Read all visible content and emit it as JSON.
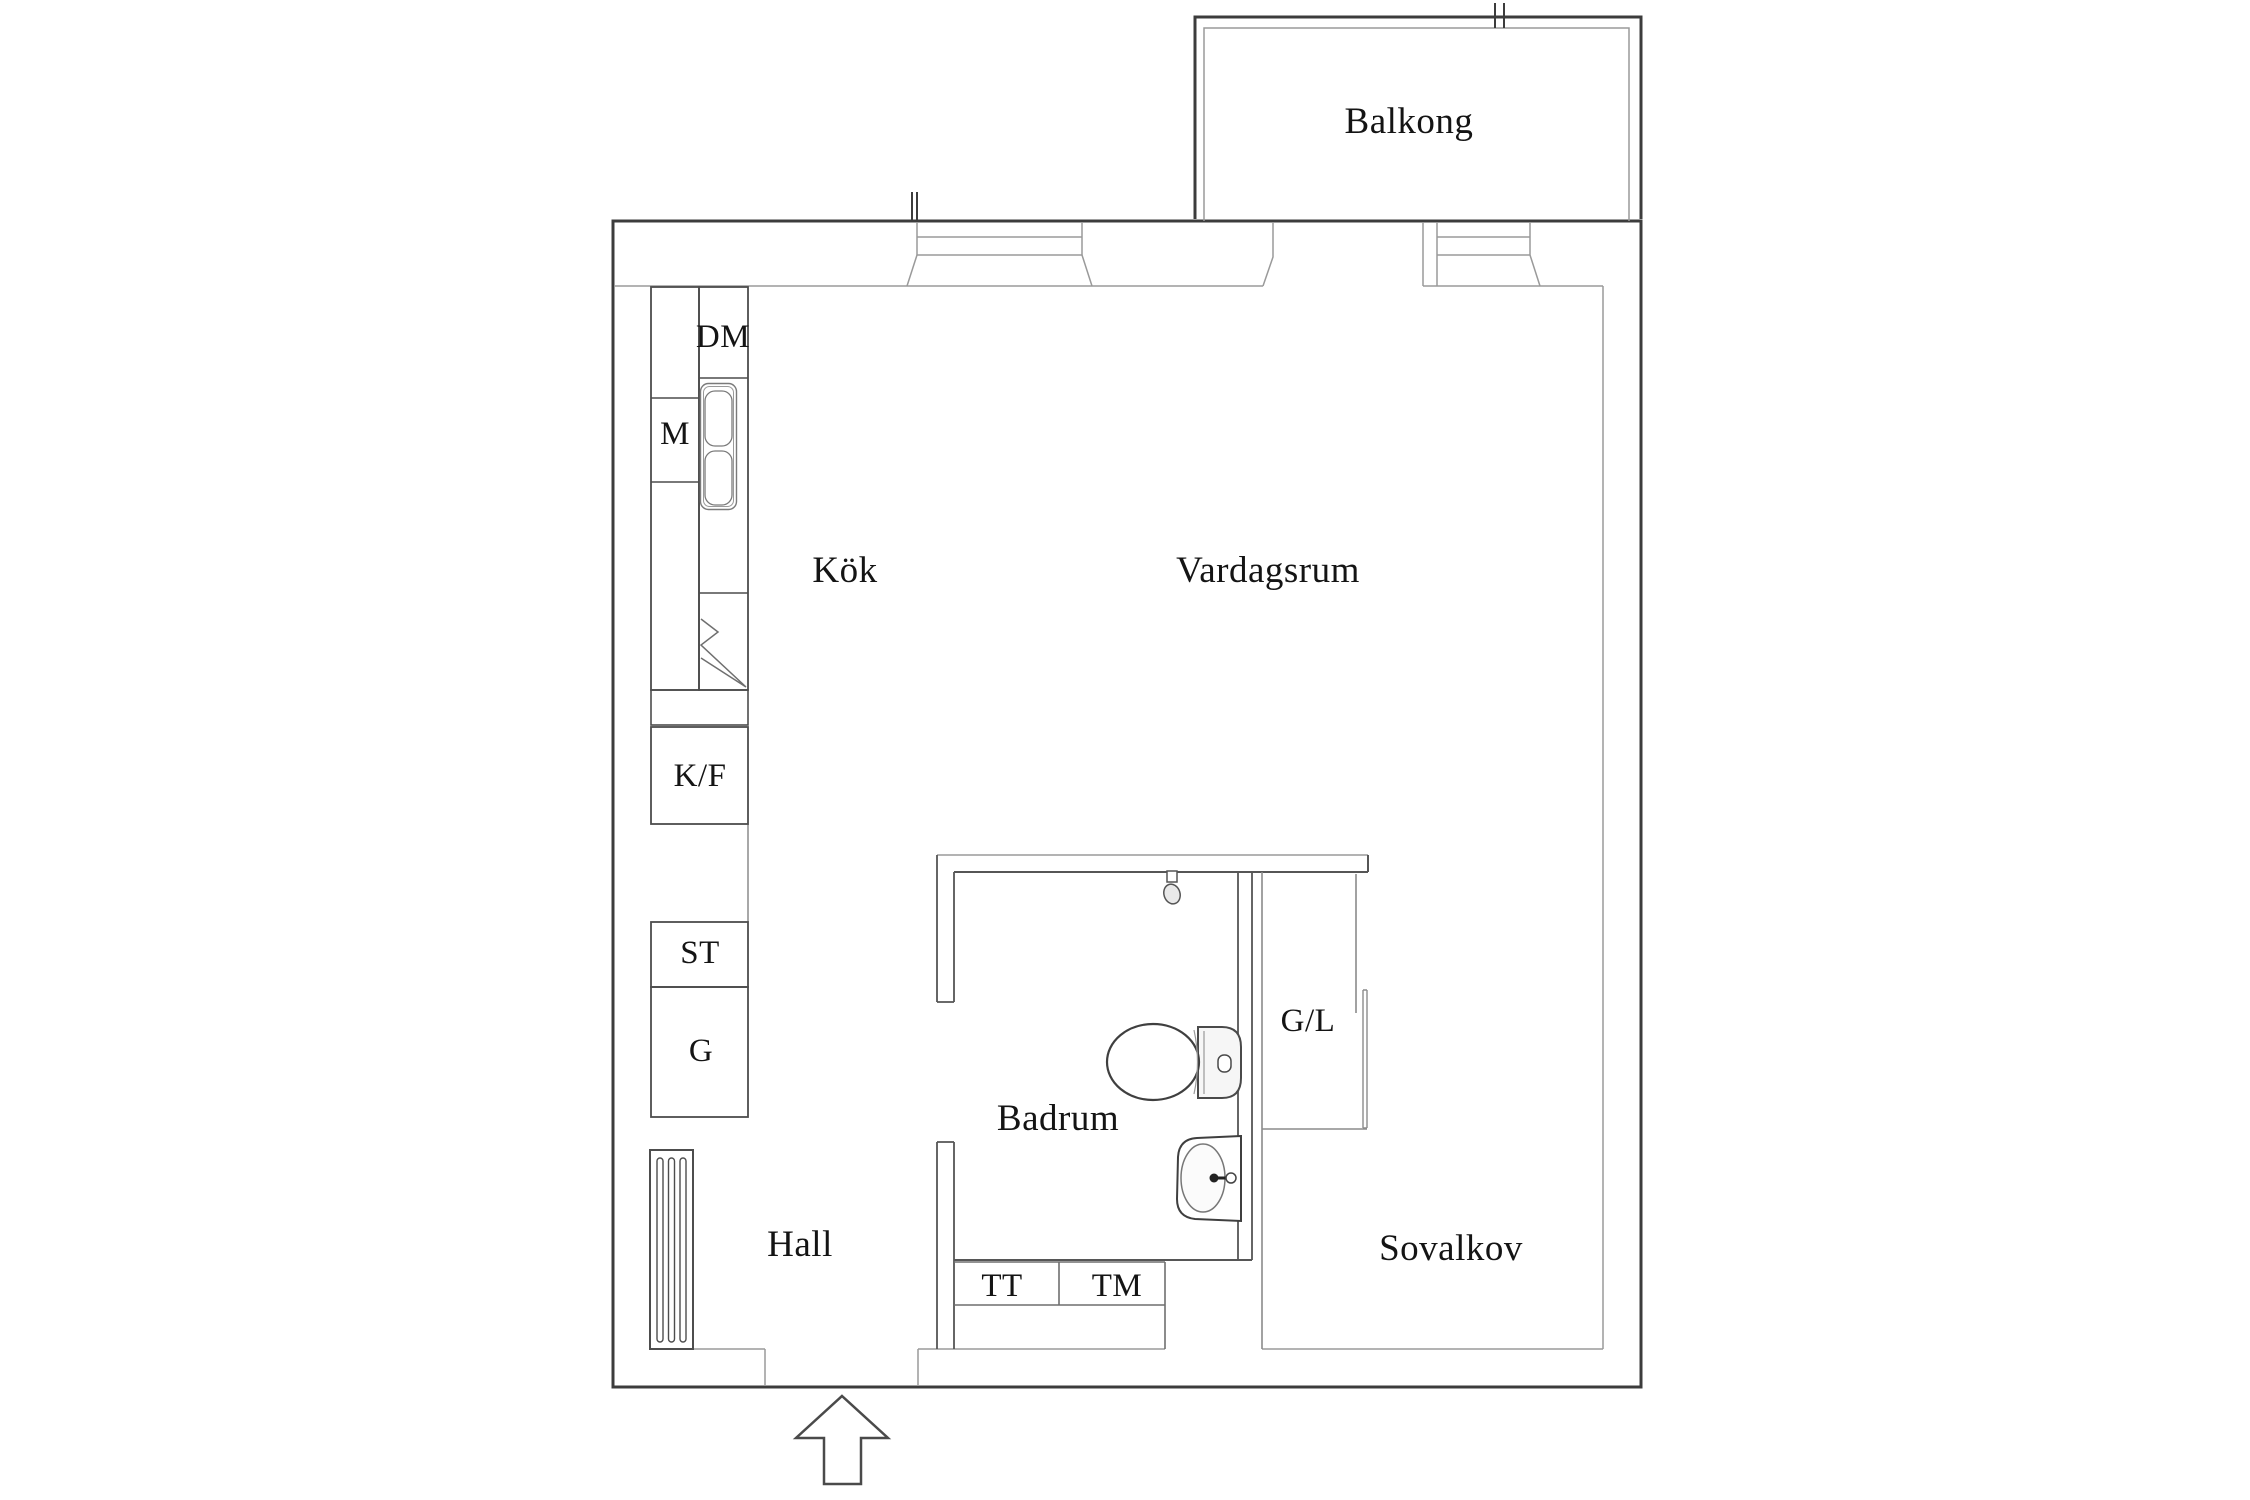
{
  "plan": {
    "rooms": {
      "balkong": "Balkong",
      "kok": "Kök",
      "vardagsrum": "Vardagsrum",
      "badrum": "Badrum",
      "hall": "Hall",
      "sovalkov": "Sovalkov"
    },
    "units": {
      "dm": "DM",
      "m": "M",
      "kf": "K/F",
      "st": "ST",
      "g": "G",
      "gl": "G/L",
      "tt": "TT",
      "tm": "TM"
    },
    "colors": {
      "wall": "#3c3c3c",
      "wall_medium": "#565656",
      "line_light": "#9a9a9a",
      "text": "#141414",
      "background": "#ffffff"
    }
  }
}
